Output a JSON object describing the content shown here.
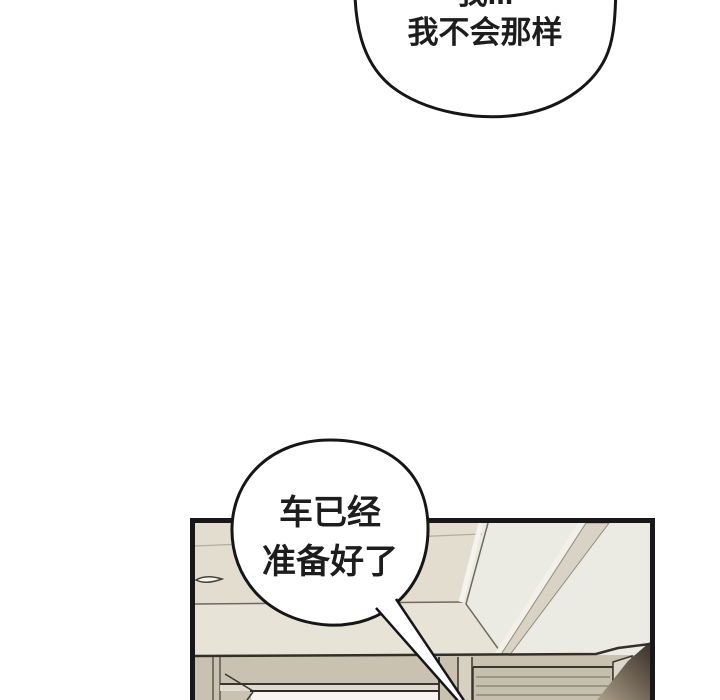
{
  "type": "webtoon-comic-page",
  "background": "#ffffff",
  "speech": {
    "top_bubble": {
      "line1": "我...",
      "line2": "我不会那样"
    },
    "bottom_bubble": {
      "line1": "车已经",
      "line2": "准备好了"
    }
  },
  "palette": {
    "outline": "#161616",
    "panel_border": "#18181a",
    "ceiling": "#ecebe3",
    "ceiling_recess": "#e2ddcf",
    "ceiling_lower": "#e7e3d7",
    "beam": "#d8d3c5",
    "wood_band": "#c9c2b1",
    "cabinet_slats": "#c6bfae",
    "door_header": "#e0dbce",
    "doorway": "#f7f5ef",
    "corner_wall": "#dcd7c9",
    "shadow_light": "#a89a84",
    "shadow_dark": "#3f392f",
    "bubble_fill": "#ffffff"
  }
}
